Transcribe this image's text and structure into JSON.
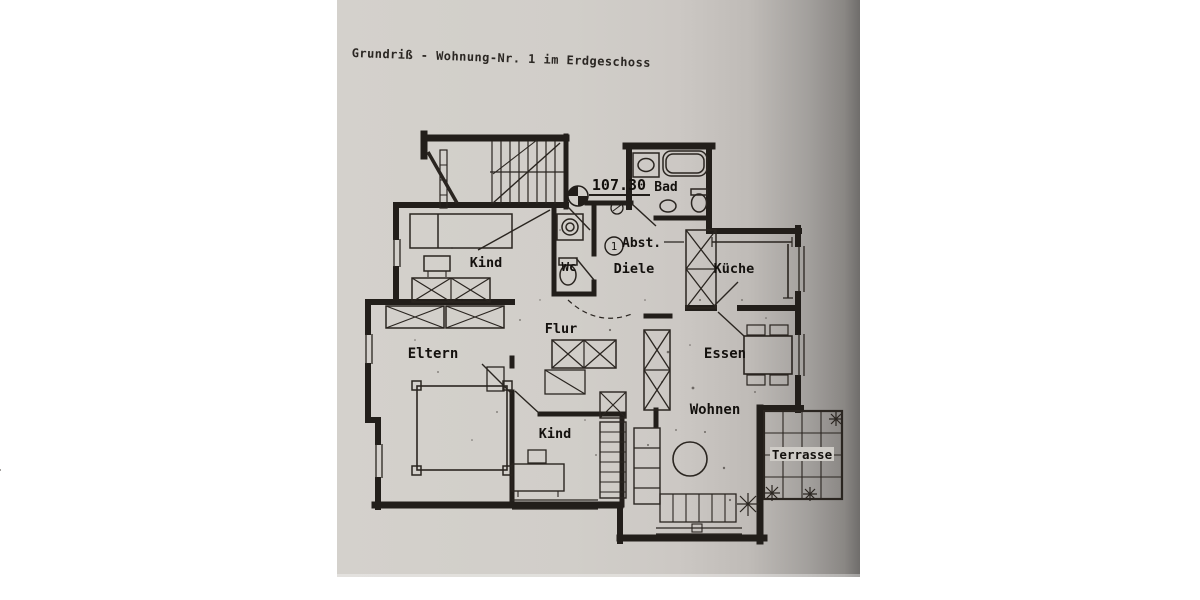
{
  "document": {
    "title": "Grundriß - Wohnung-Nr. 1 im Erdgeschoss"
  },
  "plan": {
    "labels": {
      "kind_top": "Kind",
      "wc": "Wc",
      "bad": "Bad",
      "abst": "Abst.",
      "diele": "Diele",
      "kueche": "Küche",
      "eltern": "Eltern",
      "flur": "Flur",
      "essen": "Essen",
      "wohnen": "Wohnen",
      "kind_bottom": "Kind",
      "terrasse": "Terrasse",
      "elevation": "107.30",
      "diele_number": "1"
    },
    "colors": {
      "ink": "#221e1a",
      "paper": "#d1cec9",
      "paper_shadow": "#6f6d6b"
    }
  }
}
